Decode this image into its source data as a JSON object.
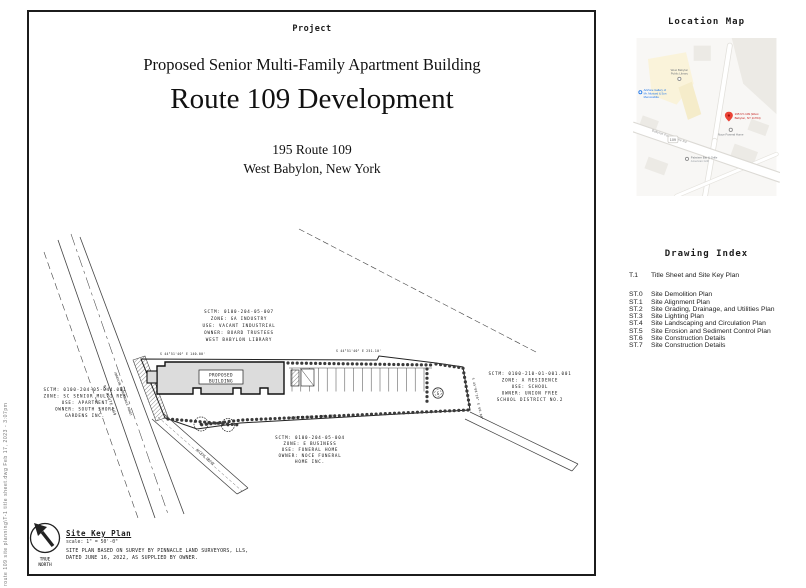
{
  "sheet": {
    "project_label": "Project",
    "subtitle": "Proposed Senior Multi-Family Apartment Building",
    "title": "Route 109 Development",
    "address_line1": "195 Route 109",
    "address_line2": "West Babylon, New York",
    "plot_stamp": "route 109 site planning\\T-1 title sheet.dwg    Feb 17, 2023 - 3:07pm"
  },
  "location_map": {
    "heading": "Location Map",
    "route_shield": "109",
    "road_label": "Babylon Farmingdale Rd",
    "pin_label_line1": "195 NY-109 (West",
    "pin_label_line2": "Babylon, NY 11704)",
    "poi_funeral": "Noce Funeral Home",
    "poi_library_line1": "West Babylon",
    "poi_library_line2": "Public Library",
    "poi_bar_line1": "Palmiere Bar & Grille",
    "poi_bar_line2": "American Grill",
    "poi_gallery_line1": "ArtZone Gallery of",
    "poi_gallery_line2": "Mr. Mustard & Son",
    "poi_gallery_line3": "Memorabilia",
    "colors": {
      "pin_red": "#ea4335",
      "poi_blue": "#1a73e8",
      "commercial_yellow": "#faf3da"
    }
  },
  "drawing_index": {
    "heading": "Drawing Index",
    "items": [
      {
        "code": "T.1",
        "title": "Title Sheet and Site Key Plan"
      },
      {
        "code": "ST.0",
        "title": "Site Demolition Plan"
      },
      {
        "code": "ST.1",
        "title": "Site Alignment Plan"
      },
      {
        "code": "ST.2",
        "title": "Site Grading, Drainage, and Utilities Plan"
      },
      {
        "code": "ST.3",
        "title": "Site Lighting Plan"
      },
      {
        "code": "ST.4",
        "title": "Site Landscaping and Circulation Plan"
      },
      {
        "code": "ST.5",
        "title": "Site Erosion and Sediment Control Plan"
      },
      {
        "code": "ST.6",
        "title": "Site Construction Details"
      },
      {
        "code": "ST.7",
        "title": "Site Construction Details"
      }
    ]
  },
  "site_plan": {
    "building_label_line1": "PROPOSED",
    "building_label_line2": "BUILDING",
    "road_label_line1": "NY ROUTE 109",
    "road_label_line2": "(BABYLON FARMINGDALE ROAD)",
    "drive_label": "ACCESS DRIVE",
    "g_marker": "G",
    "bearings": [
      "S 44°51'40\" E 140.00'",
      "S 44°51'40\" E 251.10'",
      "S 45°08'20\" E 60.00'",
      "N 44°51'40\" W 285.00'"
    ],
    "parcels": {
      "library": {
        "lines": [
          "SCTM: 0100-204-05-007",
          "ZONE: GA INDUSTRY",
          "USE: VACANT INDUSTRIAL",
          "OWNER: BOARD TRUSTEES",
          "WEST BABYLON LIBRARY"
        ]
      },
      "south_shore": {
        "lines": [
          "SCTM: 0100-204-05-044.001",
          "ZONE: SC SENIOR MULTI RES",
          "USE: APARTMENT",
          "OWNER: SOUTH SHORE",
          "GARDENS INC."
        ]
      },
      "school": {
        "lines": [
          "SCTM: 0100-210-01-001.001",
          "ZONE: A RESIDENCE",
          "USE: SCHOOL",
          "OWNER: UNION FREE",
          "SCHOOL DISTRICT NO.2"
        ]
      },
      "funeral": {
        "lines": [
          "SCTM: 0100-204-05-004",
          "ZONE: E BUSINESS",
          "USE: FUNERAL HOME",
          "OWNER: NOCE FUNERAL",
          "HOME INC."
        ]
      }
    }
  },
  "site_key": {
    "heading": "Site Key Plan",
    "scale": "scale: 1\" = 50'-0\"",
    "note_line1": "SITE PLAN BASED ON SURVEY BY PINNACLE LAND SURVEYORS, LLS,",
    "note_line2": "DATED JUNE 16, 2022, AS SUPPLIED BY OWNER.",
    "north_line1": "TRUE",
    "north_line2": "NORTH"
  }
}
